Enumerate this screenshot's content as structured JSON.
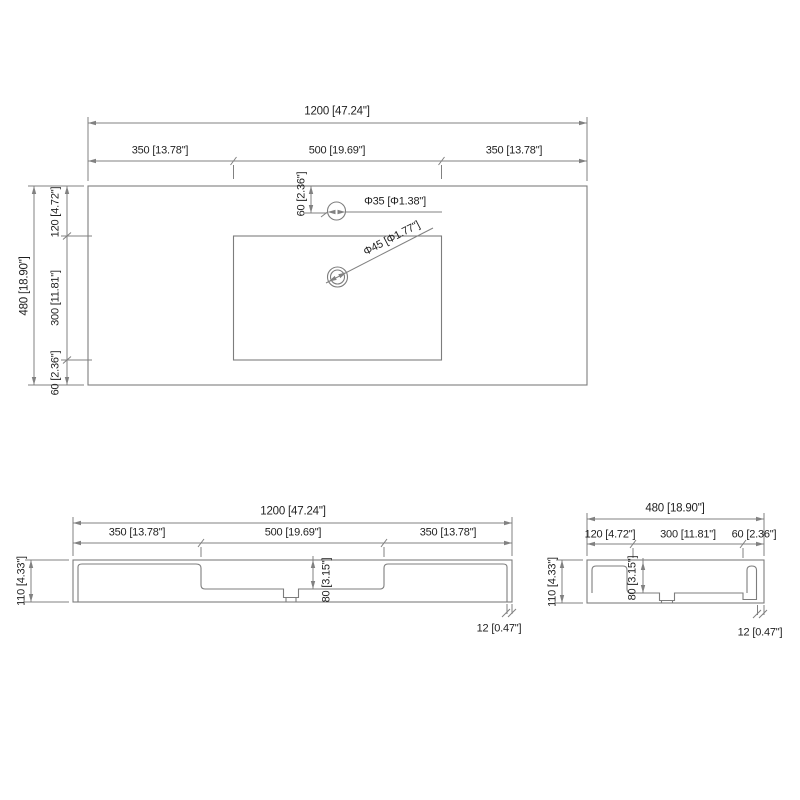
{
  "drawing_type": "sink-countertop-dimension-drawing",
  "colors": {
    "line": "#7d7d7d",
    "dim_line": "#818181",
    "text": "#1f1f1f",
    "background": "#ffffff"
  },
  "top_view": {
    "width_total": "1200 [47.24\"]",
    "width_left": "350 [13.78\"]",
    "width_center": "500 [19.69\"]",
    "width_right": "350 [13.78\"]",
    "depth_total": "480 [18.90\"]",
    "depth_top": "120 [4.72\"]",
    "depth_basin": "300 [11.81\"]",
    "depth_bottom": "60 [2.36\"]",
    "faucet_offset": "60 [2.36\"]",
    "faucet_hole_dia": "Φ35 [Φ1.38\"]",
    "drain_hole_dia": "Φ45 [Φ1.77\"]"
  },
  "front_view": {
    "width_total": "1200 [47.24\"]",
    "width_left": "350 [13.78\"]",
    "width_center": "500 [19.69\"]",
    "width_right": "350 [13.78\"]",
    "height_total": "110 [4.33\"]",
    "basin_depth": "80 [3.15\"]",
    "edge_thickness": "12 [0.47\"]"
  },
  "side_view": {
    "width_total": "480 [18.90\"]",
    "width_left": "120 [4.72\"]",
    "width_center": "300 [11.81\"]",
    "width_right": "60 [2.36\"]",
    "height_total": "110 [4.33\"]",
    "basin_depth": "80 [3.15\"]",
    "edge_thickness": "12 [0.47\"]"
  }
}
